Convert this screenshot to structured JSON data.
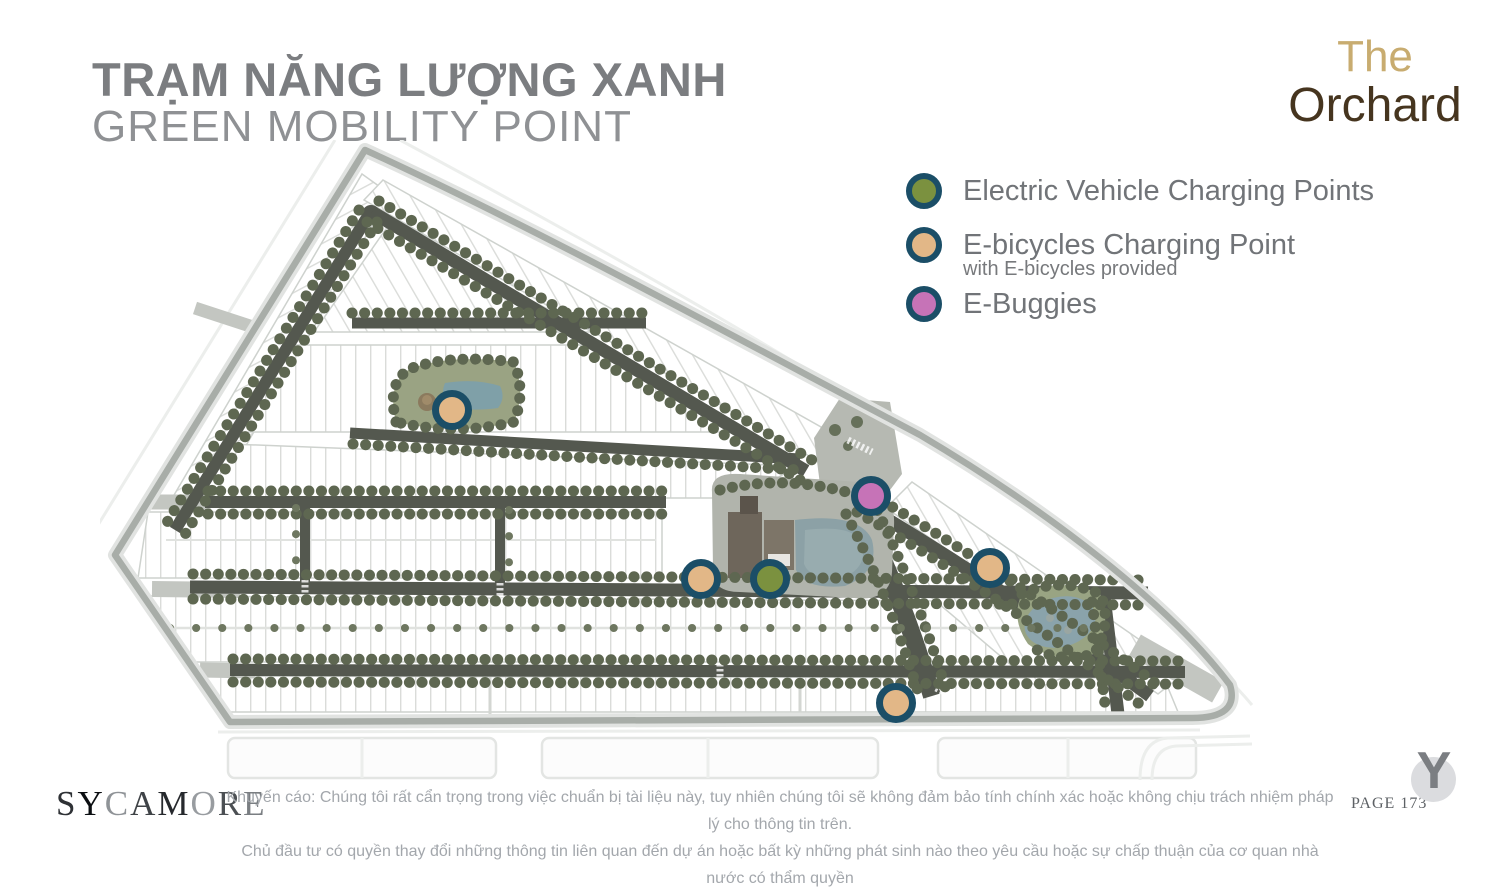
{
  "header": {
    "title_vi": "TRẠM NĂNG LƯỢNG XANH",
    "title_en": "GREEN MOBILITY POINT"
  },
  "brand": {
    "logo_line1": "The",
    "logo_line2": "Orchard",
    "developer": "SYCAMORE",
    "mark": "Y",
    "page_label": "PAGE 173",
    "gold": "#c8ac70",
    "brown": "#46351f"
  },
  "legend": {
    "items": [
      {
        "id": "ev",
        "label": "Electric Vehicle Charging Points",
        "sublabel": "",
        "color": "#7b913f",
        "ring": "#1b4e67"
      },
      {
        "id": "ebike",
        "label": "E-bicycles Charging Point",
        "sublabel": "with E-bicycles provided",
        "color": "#e2b787",
        "ring": "#1b4e67"
      },
      {
        "id": "ebuggy",
        "label": "E-Buggies",
        "sublabel": "",
        "color": "#c673b7",
        "ring": "#1b4e67"
      }
    ]
  },
  "map": {
    "markers": [
      {
        "type": "ebike",
        "x": 352,
        "y": 270
      },
      {
        "type": "ebuggy",
        "x": 771,
        "y": 356
      },
      {
        "type": "ebike",
        "x": 601,
        "y": 439
      },
      {
        "type": "ev",
        "x": 670,
        "y": 439
      },
      {
        "type": "ebike",
        "x": 890,
        "y": 428
      },
      {
        "type": "ebike",
        "x": 796,
        "y": 563
      }
    ]
  },
  "footer": {
    "disclaimer_line1": "Khuyến cáo: Chúng tôi rất cẩn trọng trong việc chuẩn bị tài liệu này, tuy nhiên chúng tôi sẽ không đảm bảo tính chính xác hoặc không chịu trách nhiệm pháp lý cho thông tin trên.",
    "disclaimer_line2": "Chủ đầu tư có quyền thay đổi những thông tin liên quan đến dự án hoặc bất kỳ những phát sinh nào theo yêu cầu hoặc sự chấp thuận của cơ quan nhà nước có thẩm quyền"
  }
}
